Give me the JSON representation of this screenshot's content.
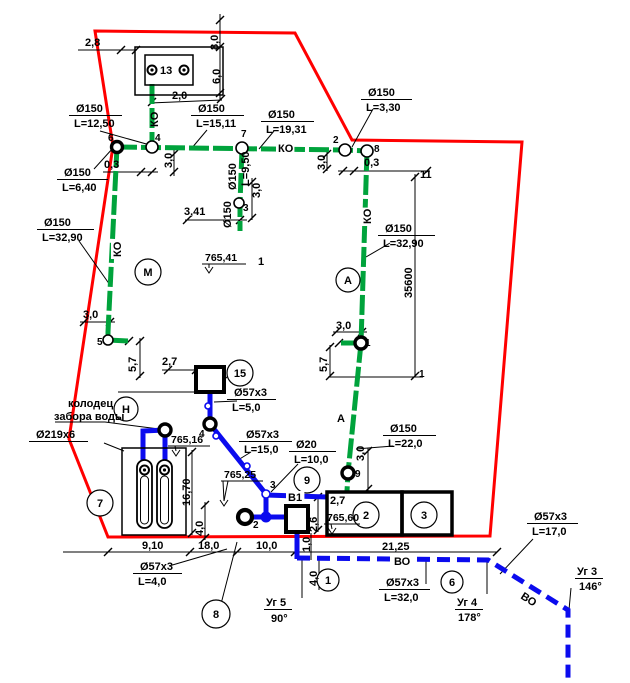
{
  "title": "Site utility plan drawing",
  "colors": {
    "pipe_green": "#00A33C",
    "pipe_blue": "#0B0BEE",
    "boundary_red": "#FF0000",
    "ink": "#000000",
    "paper": "#FFFFFF"
  },
  "drawing": {
    "boundary": "95,31 295,33 352,140 522,142 490,536 108,537 69,439 113,146",
    "green_pipes": [
      "152,84 152,147",
      "117,147 345,150 367,151",
      "242,149 240,203 240,231",
      "117,147 108,332 108,340",
      "108,340 129,341",
      "367,151 361,343 348,473 347,491",
      "361,343 339,343"
    ],
    "blue_pipes": [
      "210,391 210,424",
      "210,424 266,494",
      "266,495 327,497",
      "266,494 266,519",
      "245,517 287,517",
      "297,531 297,559",
      "143,464 143,431 165,430 165,464"
    ],
    "blue_dashed": [
      "297,558 488,560 568,610 568,680"
    ],
    "thin_lines": [
      "63,552 497,552",
      "220,14 220,100",
      "78,50 137,50",
      "150,103 222,100",
      "103,172 158,172",
      "174,150 174,176",
      "338,171 430,171",
      "327,152 327,171",
      "185,220 247,220",
      "252,178 252,220",
      "415,174 415,377",
      "328,377 423,377",
      "330,345 330,377",
      "333,332 367,332",
      "80,322 115,322",
      "140,338 140,378",
      "162,370 212,370",
      "118,392 196,392",
      "192,450 192,535",
      "205,502 205,540",
      "368,448 368,491",
      "318,495 318,532",
      "311,533 311,560",
      "319,560 319,590"
    ],
    "leaders": [
      "100,131 150,145",
      "207,130 191,149",
      "274,131 259,149",
      "373,109 352,147",
      "94,169 113,148",
      "79,241 110,285",
      "390,243 366,257",
      "393,446 356,449",
      "298,464 271,492",
      "251,452 238,460",
      "237,401 214,402",
      "104,443 124,451",
      "55,422 105,422 159,429",
      "228,376 221,383",
      "221,604 237,542",
      "169,566 227,549",
      "426,560 426,584",
      "487,561 487,594",
      "302,559 302,598",
      "571,588 569,610",
      "533,539 500,574"
    ],
    "ticks": [
      [
        121,
        50
      ],
      [
        136,
        50
      ],
      [
        220,
        20
      ],
      [
        220,
        47
      ],
      [
        220,
        93
      ],
      [
        152,
        102
      ],
      [
        221,
        99
      ],
      [
        141,
        172
      ],
      [
        152,
        172
      ],
      [
        174,
        154
      ],
      [
        174,
        172
      ],
      [
        343,
        171
      ],
      [
        354,
        171
      ],
      [
        427,
        171
      ],
      [
        327,
        154
      ],
      [
        327,
        169
      ],
      [
        187,
        220
      ],
      [
        240,
        220
      ],
      [
        252,
        182
      ],
      [
        252,
        218
      ],
      [
        415,
        177
      ],
      [
        415,
        376
      ],
      [
        330,
        347
      ],
      [
        330,
        376
      ],
      [
        336,
        332
      ],
      [
        362,
        332
      ],
      [
        84,
        322
      ],
      [
        110,
        322
      ],
      [
        140,
        341
      ],
      [
        140,
        376
      ],
      [
        168,
        370
      ],
      [
        196,
        370
      ],
      [
        192,
        452
      ],
      [
        192,
        533
      ],
      [
        205,
        505
      ],
      [
        205,
        538
      ],
      [
        368,
        451
      ],
      [
        368,
        489
      ],
      [
        108,
        552
      ],
      [
        190,
        552
      ],
      [
        237,
        552
      ],
      [
        295,
        552
      ],
      [
        497,
        552
      ],
      [
        318,
        497
      ],
      [
        318,
        530
      ],
      [
        129,
        341
      ],
      [
        339,
        343
      ]
    ],
    "nodes": [
      {
        "x": 117,
        "y": 147,
        "r": 5.5,
        "kind": "ring"
      },
      {
        "x": 361,
        "y": 343,
        "r": 6,
        "kind": "ring"
      },
      {
        "x": 348,
        "y": 473,
        "r": 6,
        "kind": "ring"
      },
      {
        "x": 165,
        "y": 430,
        "r": 6,
        "kind": "ring"
      },
      {
        "x": 210,
        "y": 424,
        "r": 6,
        "kind": "ring"
      },
      {
        "x": 245,
        "y": 517,
        "r": 7,
        "kind": "pump"
      },
      {
        "x": 152,
        "y": 147,
        "r": 6,
        "kind": "open"
      },
      {
        "x": 242,
        "y": 148,
        "r": 6,
        "kind": "open"
      },
      {
        "x": 345,
        "y": 150,
        "r": 6,
        "kind": "open"
      },
      {
        "x": 367,
        "y": 151,
        "r": 6,
        "kind": "open"
      },
      {
        "x": 239,
        "y": 203,
        "r": 5,
        "kind": "open"
      },
      {
        "x": 108,
        "y": 340,
        "r": 5,
        "kind": "open"
      },
      {
        "x": 266,
        "y": 494,
        "r": 4,
        "kind": "blue-open"
      },
      {
        "x": 208,
        "y": 406,
        "r": 3,
        "kind": "blue-open"
      },
      {
        "x": 216,
        "y": 436,
        "r": 3,
        "kind": "blue-open"
      },
      {
        "x": 247,
        "y": 466,
        "r": 3,
        "kind": "blue-open"
      },
      {
        "x": 266,
        "y": 517,
        "r": 5,
        "kind": "blue-fill"
      }
    ],
    "squares": [
      {
        "x": 196,
        "y": 367,
        "w": 28,
        "h": 25,
        "name": "chamber-15-square"
      },
      {
        "x": 286,
        "y": 506,
        "w": 22,
        "h": 26,
        "name": "valve-square"
      }
    ],
    "rects": [
      {
        "x": 135,
        "y": 47,
        "w": 88,
        "h": 48,
        "lw": 1.5,
        "name": "structure-13-outer"
      },
      {
        "x": 145,
        "y": 55,
        "w": 48,
        "h": 30,
        "lw": 1.5,
        "name": "structure-13-inner"
      },
      {
        "x": 122,
        "y": 448,
        "w": 64,
        "h": 87,
        "lw": 1.5,
        "name": "wellhouse-rect"
      },
      {
        "x": 327,
        "y": 492,
        "w": 75,
        "h": 43,
        "lw": 3.5,
        "name": "building-section-2"
      },
      {
        "x": 402,
        "y": 492,
        "w": 50,
        "h": 43,
        "lw": 3.5,
        "name": "building-section-3"
      }
    ],
    "capsules": [
      {
        "x": 137,
        "y": 460,
        "w": 15,
        "h": 68,
        "lw": 1.8
      },
      {
        "x": 157,
        "y": 460,
        "w": 15,
        "h": 68,
        "lw": 1.8
      },
      {
        "x": 140.5,
        "y": 476,
        "w": 8,
        "h": 48,
        "lw": 1
      },
      {
        "x": 160.5,
        "y": 476,
        "w": 8,
        "h": 48,
        "lw": 1
      }
    ],
    "bolts": [
      [
        152,
        70
      ],
      [
        184,
        70
      ],
      [
        144.5,
        470
      ],
      [
        164.5,
        470
      ]
    ],
    "bubbles": [
      {
        "x": 148,
        "y": 272,
        "r": 13,
        "t": "М"
      },
      {
        "x": 348,
        "y": 280,
        "r": 12,
        "t": "А"
      },
      {
        "x": 126,
        "y": 409,
        "r": 12,
        "t": "Н"
      },
      {
        "x": 100,
        "y": 503,
        "r": 13,
        "t": "7"
      },
      {
        "x": 240,
        "y": 373,
        "r": 13,
        "t": "15"
      },
      {
        "x": 307,
        "y": 480,
        "r": 13,
        "t": "9"
      },
      {
        "x": 366,
        "y": 515,
        "r": 13,
        "t": "2"
      },
      {
        "x": 424,
        "y": 515,
        "r": 13,
        "t": "3"
      },
      {
        "x": 328,
        "y": 580,
        "r": 11,
        "t": "1"
      },
      {
        "x": 452,
        "y": 582,
        "r": 11,
        "t": "6"
      },
      {
        "x": 216,
        "y": 614,
        "r": 14,
        "t": "8"
      }
    ],
    "dlabels": [
      {
        "x": 76,
        "y": 112,
        "w": 46,
        "l1": "Ø150",
        "l2": "L=12,50"
      },
      {
        "x": 198,
        "y": 112,
        "w": 46,
        "l1": "Ø150",
        "l2": "L=15,11"
      },
      {
        "x": 268,
        "y": 118,
        "w": 46,
        "l1": "Ø150",
        "l2": "L=19,31"
      },
      {
        "x": 368,
        "y": 96,
        "w": 44,
        "l1": "Ø150",
        "l2": "L=3,30"
      },
      {
        "x": 64,
        "y": 176,
        "w": 44,
        "l1": "Ø150",
        "l2": "L=6,40"
      },
      {
        "x": 44,
        "y": 226,
        "w": 50,
        "l1": "Ø150",
        "l2": "L=32,90"
      },
      {
        "x": 385,
        "y": 232,
        "w": 50,
        "l1": "Ø150",
        "l2": "L=32,90"
      },
      {
        "x": 390,
        "y": 432,
        "w": 46,
        "l1": "Ø150",
        "l2": "L=22,0"
      },
      {
        "x": 234,
        "y": 396,
        "w": 42,
        "l1": "Ø57x3",
        "l2": "L=5,0"
      },
      {
        "x": 246,
        "y": 438,
        "w": 46,
        "l1": "Ø57x3",
        "l2": "L=15,0"
      },
      {
        "x": 296,
        "y": 448,
        "w": 40,
        "l1": "Ø20",
        "l2": "L=10,0"
      },
      {
        "x": 140,
        "y": 570,
        "w": 42,
        "l1": "Ø57x3",
        "l2": "L=4,0"
      },
      {
        "x": 386,
        "y": 586,
        "w": 44,
        "l1": "Ø57x3",
        "l2": "L=32,0"
      },
      {
        "x": 534,
        "y": 520,
        "w": 44,
        "l1": "Ø57x3",
        "l2": "L=17,0"
      },
      {
        "x": 36,
        "y": 438,
        "w": 52,
        "l1": "Ø219x6",
        "l2": ""
      }
    ],
    "texts": [
      {
        "t": "2,8",
        "x": 85,
        "y": 46
      },
      {
        "t": "13",
        "x": 160,
        "y": 74
      },
      {
        "t": "8,0",
        "x": 218,
        "y": 50,
        "rot": -90
      },
      {
        "t": "6,0",
        "x": 220,
        "y": 84,
        "rot": -90
      },
      {
        "t": "2,0",
        "x": 172,
        "y": 99
      },
      {
        "t": "КО",
        "x": 158,
        "y": 127,
        "rot": -90
      },
      {
        "t": "6",
        "x": 108,
        "y": 141,
        "s": 10
      },
      {
        "t": "4",
        "x": 155,
        "y": 141,
        "s": 10
      },
      {
        "t": "7",
        "x": 241,
        "y": 137,
        "s": 10
      },
      {
        "t": "2",
        "x": 333,
        "y": 143,
        "s": 10
      },
      {
        "t": "8",
        "x": 374,
        "y": 152,
        "s": 10
      },
      {
        "t": "КО",
        "x": 278,
        "y": 152,
        "bg": 1
      },
      {
        "t": "3,0",
        "x": 172,
        "y": 168,
        "rot": -90
      },
      {
        "t": "0,3",
        "x": 104,
        "y": 168
      },
      {
        "t": "3,0",
        "x": 325,
        "y": 170,
        "rot": -90
      },
      {
        "t": "0,3",
        "x": 364,
        "y": 166
      },
      {
        "t": "11",
        "x": 420,
        "y": 178
      },
      {
        "t": "Ø150",
        "x": 236,
        "y": 190,
        "rot": -90
      },
      {
        "t": "L=9,50",
        "x": 249,
        "y": 186,
        "rot": -90
      },
      {
        "t": "3,0",
        "x": 260,
        "y": 198,
        "rot": -90
      },
      {
        "t": "Ø150",
        "x": 231,
        "y": 228,
        "rot": -90
      },
      {
        "t": "3",
        "x": 243,
        "y": 211,
        "s": 10
      },
      {
        "t": "3,41",
        "x": 184,
        "y": 215
      },
      {
        "t": "КО",
        "x": 121,
        "y": 257,
        "rot": -90,
        "bg": 1
      },
      {
        "t": "КО",
        "x": 371,
        "y": 224,
        "rot": -90,
        "bg": 1
      },
      {
        "t": "1",
        "x": 258,
        "y": 265
      },
      {
        "t": "А",
        "x": 337,
        "y": 422
      },
      {
        "t": "35600",
        "x": 412,
        "y": 298,
        "rot": -90
      },
      {
        "t": "3,0",
        "x": 336,
        "y": 329
      },
      {
        "t": "1",
        "x": 365,
        "y": 346,
        "s": 10
      },
      {
        "t": "5,7",
        "x": 327,
        "y": 372,
        "rot": -90
      },
      {
        "t": "1",
        "x": 419,
        "y": 377,
        "s": 10
      },
      {
        "t": "3,0",
        "x": 83,
        "y": 318
      },
      {
        "t": "5",
        "x": 97,
        "y": 345,
        "s": 10
      },
      {
        "t": "5,7",
        "x": 136,
        "y": 372,
        "rot": -90
      },
      {
        "t": "2,7",
        "x": 162,
        "y": 365
      },
      {
        "t": "колодец",
        "x": 68,
        "y": 407
      },
      {
        "t": "забора воды",
        "x": 54,
        "y": 420
      },
      {
        "t": "4",
        "x": 199,
        "y": 437,
        "s": 10
      },
      {
        "t": "16,70",
        "x": 190,
        "y": 506,
        "rot": -90
      },
      {
        "t": "4,0",
        "x": 203,
        "y": 536,
        "rot": -90
      },
      {
        "t": "3",
        "x": 270,
        "y": 488,
        "s": 10
      },
      {
        "t": "В1",
        "x": 288,
        "y": 501,
        "bg": 1
      },
      {
        "t": "2,7",
        "x": 330,
        "y": 504
      },
      {
        "t": "9",
        "x": 355,
        "y": 477,
        "s": 10
      },
      {
        "t": "3,0",
        "x": 364,
        "y": 461,
        "rot": -90
      },
      {
        "t": "2",
        "x": 253,
        "y": 528,
        "s": 10
      },
      {
        "t": "2,6",
        "x": 317,
        "y": 532,
        "rot": -90
      },
      {
        "t": "1,0",
        "x": 310,
        "y": 552,
        "rot": -90
      },
      {
        "t": "4,0",
        "x": 317,
        "y": 586,
        "rot": -90
      },
      {
        "t": "9,10",
        "x": 142,
        "y": 549
      },
      {
        "t": "18,0",
        "x": 198,
        "y": 549
      },
      {
        "t": "10,0",
        "x": 256,
        "y": 549
      },
      {
        "t": "21,25",
        "x": 382,
        "y": 550
      },
      {
        "t": "ВО",
        "x": 394,
        "y": 565,
        "bg": 1
      },
      {
        "t": "ВО",
        "x": 520,
        "y": 598,
        "rot": 33,
        "bg": 1
      },
      {
        "t": "Уг 5",
        "x": 266,
        "y": 606,
        "ul": 26
      },
      {
        "t": "90°",
        "x": 271,
        "y": 622
      },
      {
        "t": "Уг 4",
        "x": 457,
        "y": 606,
        "ul": 26
      },
      {
        "t": "178°",
        "x": 458,
        "y": 621
      },
      {
        "t": "Уг 3",
        "x": 577,
        "y": 575,
        "ul": 26
      },
      {
        "t": "146°",
        "x": 579,
        "y": 590
      }
    ],
    "elevations": [
      {
        "t": "765,41",
        "x": 205,
        "y": 261,
        "shelf": [
          202,
          264,
          246,
          264
        ],
        "tip": [
          209,
          273
        ]
      },
      {
        "t": "765,16",
        "x": 171,
        "y": 443,
        "shelf": [
          168,
          446,
          210,
          446
        ],
        "tip": [
          176,
          456
        ]
      },
      {
        "t": "765,25",
        "x": 224,
        "y": 478,
        "shelf": [
          221,
          481,
          263,
          481
        ],
        "tip": [
          224,
          506
        ],
        "leader": "223,481 224,501"
      },
      {
        "t": "765,60",
        "x": 327,
        "y": 521,
        "shelf": [
          324,
          524,
          360,
          524
        ],
        "tip": [
          332,
          534
        ]
      }
    ]
  }
}
